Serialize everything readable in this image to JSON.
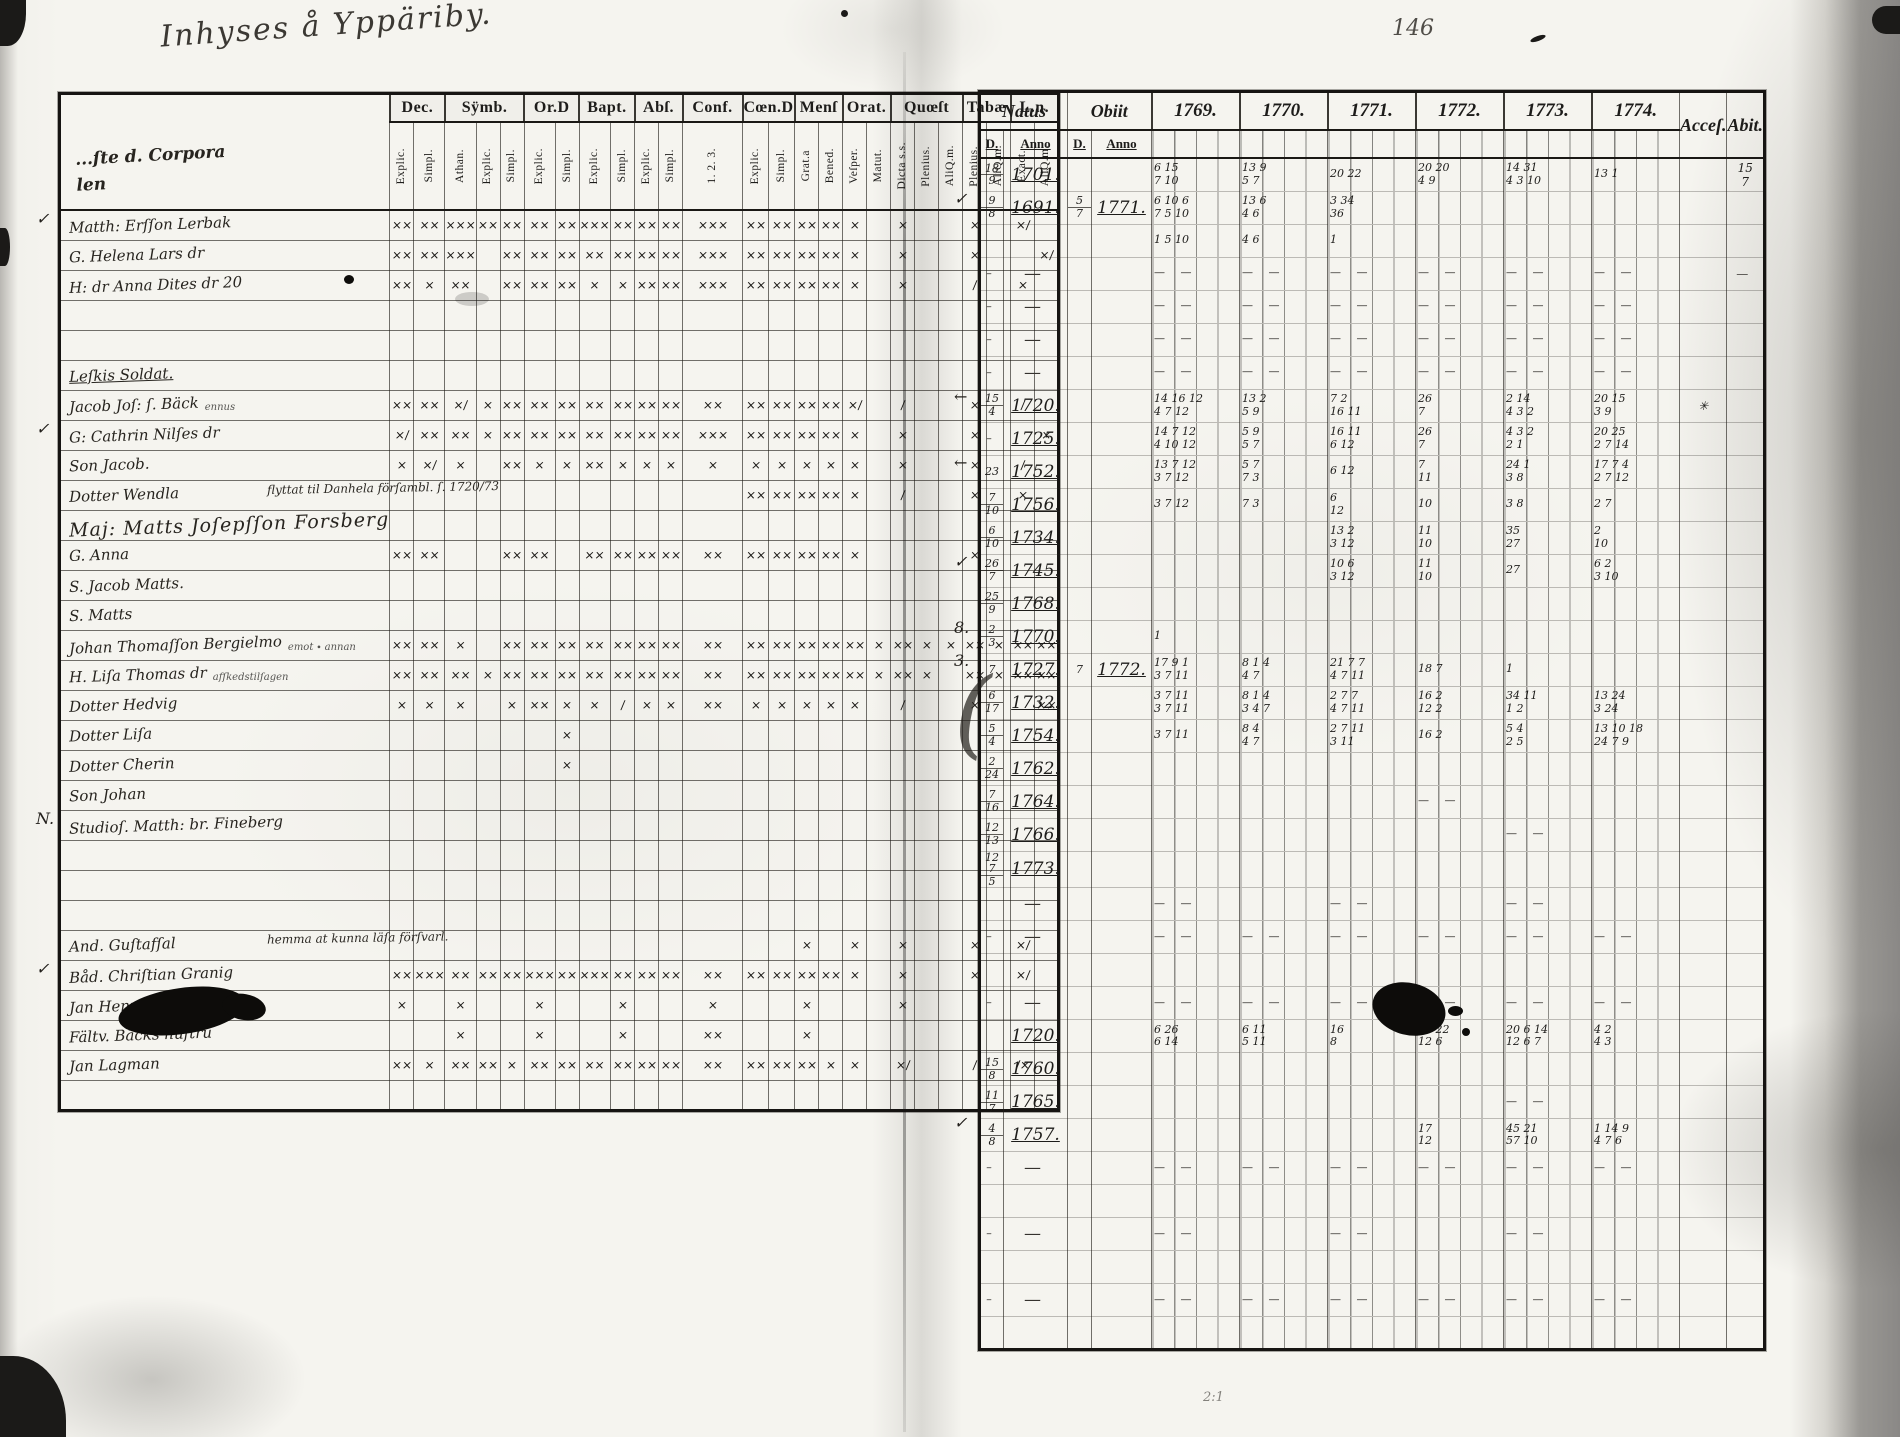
{
  "inscription": "Inhyses å Yppäriby.",
  "page_number": "146",
  "bottom_mark": "2:1",
  "left_table": {
    "name_header_lines": [
      "...ſte d. Corpora",
      "len"
    ],
    "groups": [
      {
        "label": "Dec.",
        "subs": [
          "Explic.",
          "Simpl."
        ]
      },
      {
        "label": "Sÿmb.",
        "subs": [
          "Athan.",
          "Explic.",
          "Simpl."
        ]
      },
      {
        "label": "Or.D",
        "subs": [
          "Explic.",
          "Simpl."
        ]
      },
      {
        "label": "Bapt.",
        "subs": [
          "Explic.",
          "Simpl."
        ]
      },
      {
        "label": "Abſ.",
        "subs": [
          "Explic.",
          "Simpl."
        ]
      },
      {
        "label": "Conf.",
        "subs": [
          "1. 2. 3."
        ]
      },
      {
        "label": "Cœn.D",
        "subs": [
          "Explic.",
          "Simpl."
        ]
      },
      {
        "label": "Menſ",
        "subs": [
          "Grat.a",
          "Bened."
        ]
      },
      {
        "label": "Orat.",
        "subs": [
          "Veſper.",
          "Matut."
        ]
      },
      {
        "label": "Quœſt",
        "subs": [
          "Dicta s.s.",
          "Plenius.",
          "AliQ.m."
        ]
      },
      {
        "label": "Tabæ",
        "subs": [
          "Plenius.",
          "AliQ.m."
        ]
      },
      {
        "label": "L.n.",
        "subs": [
          "Exact.",
          "AliQ.m."
        ]
      }
    ],
    "col_widths": [
      24,
      24,
      24,
      24,
      24,
      24,
      24,
      24,
      24,
      24,
      24,
      60,
      24,
      24,
      24,
      24,
      24,
      24,
      24,
      24,
      24,
      24,
      24,
      24,
      24
    ],
    "name_col_width": 185,
    "rows": [
      {
        "c": "✓",
        "n": "Matth: Erſſon Lerbak",
        "mk": "xx xx xxx xx xx xx xx xxx xx xx xx xxx xx xx xx xx x . x . . x . x/ ."
      },
      {
        "n": "G. Helena Lars dr",
        "mk": "xx xx xxx . xx xx xx xx xx xx xx xxx xx xx xx xx x . x . . x . . x/"
      },
      {
        "n": "H: dr Anna Dites dr 20",
        "mk": "xx x xx . xx xx xx x x xx xx xxx xx xx xx xx x . x . . / . x ."
      },
      {
        "n": "",
        "mk": ". . . . . . . . . . . . . . . . . . . . . . . . ."
      },
      {
        "n": "",
        "mk": ". . . . . . . . . . . . . . . . . . . . . . . . ."
      },
      {
        "n": "Leſkis Soldat.",
        "cls": "heading",
        "mk": ". . . . . . . . . . . . . . . . . . . . . . . . ."
      },
      {
        "n": "Jacob Joſ: ſ. Bäck",
        "pre": "ennus",
        "mk": "xx xx x/ x xx xx xx xx xx xx xx xx xx xx xx xx x/ . / . . x . / ."
      },
      {
        "c": "✓",
        "n": "G: Cathrin Nilſes dr",
        "mk": "x/ xx xx x xx xx xx xx xx xx xx xxx xx xx xx xx x . x . . x . . x"
      },
      {
        "n": "Son Jacob.",
        "mk": "x x/ x . xx x x xx x x x x x x x x x . x . . x . / ."
      },
      {
        "n": "Dotter Wendla",
        "span": {
          "s": 1,
          "e": 11,
          "t": "flyttat til Danhela förſambl. ſ. 1720/73"
        },
        "mk": ". . . . . . . . . . . . xx xx xx xx x . / . . x . x ."
      },
      {
        "n": "Maj: Matts Joſepſſon Forsberg",
        "cls": "big",
        "mk": ". . . . . . . . . . . . . . . . . . . . . . . . ."
      },
      {
        "n": "G. Anna",
        "mk": "xx xx . . xx xx . xx xx xx xx xx xx xx xx xx x . . . . x . . ."
      },
      {
        "n": "S. Jacob Matts.",
        "mk": ". . . . . . . . . . . . . . . . . . . . . . . . ."
      },
      {
        "n": "S. Matts",
        "mk": ". . . . . . . . . . . . . . . . . . . . . . . . ."
      },
      {
        "n": "Johan Thomaſſon Bergielmo",
        "pre": "emot ∙ annan",
        "mk": "xx xx x . xx xx xx xx xx xx xx xx xx xx xx xx xx x xx x x xx x xx xx"
      },
      {
        "n": "H. Liſa Thomas dr",
        "pre": "afſkedstilſagen",
        "mk": "xx xx xx x xx xx xx xx xx xx xx xx xx xx xx xx xx x xx x . xx x xx xx"
      },
      {
        "n": "Dotter Hedvig",
        "mk": "x x x . x xx x x / x x xx x x x x x . / . . x . . xx"
      },
      {
        "n": "Dotter Liſa",
        "mk": ". . . . . . x . . . . . . . . . . . . . . . . . ."
      },
      {
        "n": "Dotter Cherin",
        "mk": ". . . . . . x . . . . . . . . . . . . . . . . . ."
      },
      {
        "n": "Son Johan",
        "mk": ". . . . . . . . . . . . . . . . . . . . . . . . ."
      },
      {
        "c": "N.",
        "n": "Studioſ. Matth: br. Fineberg",
        "mk": ". . . . . . . . . . . . . . . . . . . . . . . . ."
      },
      {
        "n": "",
        "mk": ". . . . . . . . . . . . . . . . . . . . . . . . ."
      },
      {
        "n": "",
        "mk": ". . . . . . . . . . . . . . . . . . . . . . . . ."
      },
      {
        "n": "",
        "mk": ". . . . . . . . . . . . . . . . . . . . . . . . ."
      },
      {
        "n": "And. Guſtafſal",
        "span": {
          "s": 1,
          "e": 13,
          "t": "hemma at kunna läſa förſvarl."
        },
        "mk": ". . . . . . . . . . . . . . x . x . x . . x . x/ ."
      },
      {
        "c": "✓",
        "n": "Båd. Chriſtian Granig",
        "mk": "xx xxx xx xx xx xxx xx xxx xx xx xx xx xx xx xx xx x . x . . x . x/ ."
      },
      {
        "n": "Jan Henrig Söderberg",
        "mk": "x . x . . x . . x . . x . . x . . . x . . . . . ."
      },
      {
        "n": "Fältv. Bäcks huſtru",
        "mk": ". . x . . x . . x . . xx . . x . . . . . . . . . ."
      },
      {
        "n": "Jan Lagman",
        "mk": "xx x xx xx x xx xx xx xx xx xx xx xx xx xx x x . x/ . . / . /x ."
      },
      {
        "n": "",
        "mk": ". . . . . . . . . . . . . . . . . . . . . . . . ."
      }
    ]
  },
  "right_table": {
    "natus_label": "Natus",
    "obiit_label": "Obiit",
    "day_label": "D.",
    "anno_label": "Anno",
    "years": [
      "1769.",
      "1770.",
      "1771.",
      "1772.",
      "1773.",
      "1774."
    ],
    "acces_label": "Acceſ.",
    "abit_label": "Abit.",
    "rows": [
      [
        "",
        "18|9",
        "1701.",
        "",
        "",
        [
          "6 15|7 10",
          "13 9|5 7",
          "20 22",
          "20 20|4 9",
          "14 31|4 3 10",
          "13 1"
        ],
        "",
        "15|7"
      ],
      [
        "✓",
        "9|8",
        "1691.",
        "5|7",
        "1771.",
        [
          "6 10 6|7 5 10",
          "13 6|4 6",
          "3 34|36",
          "",
          "",
          ""
        ],
        "",
        ""
      ],
      [
        "",
        "",
        "",
        "",
        "",
        [
          "1 5 10",
          "4 6",
          "1",
          "",
          "",
          ""
        ],
        "",
        ""
      ],
      [
        "",
        "–",
        "—",
        "",
        "",
        [
          "— —",
          "— —",
          "— —",
          "— —",
          "— —",
          "— —"
        ],
        "",
        "—"
      ],
      [
        "",
        "–",
        "—",
        "",
        "",
        [
          "— —",
          "— —",
          "— —",
          "— —",
          "— —",
          "— —"
        ],
        "",
        ""
      ],
      [
        "",
        "–",
        "—",
        "",
        "",
        [
          "— —",
          "— —",
          "— —",
          "— —",
          "— —",
          "— —"
        ],
        "",
        ""
      ],
      [
        "",
        "–",
        "—",
        "",
        "",
        [
          "— —",
          "— —",
          "— —",
          "— —",
          "— —",
          "— —"
        ],
        "",
        ""
      ],
      [
        "←",
        "15|4",
        "1720.",
        "",
        "",
        [
          "14 16 12|4 7 12",
          "13 2|5 9",
          "7 2|16 11",
          "26|7",
          "2 14|4 3 2",
          "20 15|3 9"
        ],
        "✳",
        ""
      ],
      [
        "",
        "–",
        "1725.",
        "",
        "",
        [
          "14 7 12|4 10 12",
          "5 9|5 7",
          "16 11|6 12",
          "26|7",
          "4 3 2|2 1",
          "20 25|2 7 14"
        ],
        "",
        ""
      ],
      [
        "←",
        "23",
        "1752.",
        "",
        "",
        [
          "13 7 12|3 7 12",
          "5 7|7 3",
          "6 12",
          "7|11",
          "24 1|3 8",
          "17 7 4|2 7 12"
        ],
        "",
        ""
      ],
      [
        "",
        "7|10",
        "1756.",
        "",
        "",
        [
          "3 7 12",
          "7 3",
          "6|12",
          "10",
          "3 8",
          "2 7"
        ],
        "",
        ""
      ],
      [
        "",
        "6|10",
        "1734.",
        "",
        "",
        [
          "",
          "",
          "13 2|3 12",
          "11|10",
          "35|27",
          "2|10"
        ],
        "",
        ""
      ],
      [
        "✓",
        "26|7",
        "1745.",
        "",
        "",
        [
          "",
          "",
          "10 6|3 12",
          "11|10",
          "27",
          "6 2|3 10"
        ],
        "",
        ""
      ],
      [
        "",
        "25|9",
        "1768.",
        "",
        "",
        [
          "",
          "",
          "",
          "",
          "",
          ""
        ],
        "",
        ""
      ],
      [
        "8.",
        "2|3",
        "1770.",
        "",
        "",
        [
          "1",
          "",
          "",
          "",
          "",
          ""
        ],
        "",
        ""
      ],
      [
        "3.",
        "7",
        "1727.",
        "7",
        "1772.",
        [
          "17 9 1|3 7 11",
          "8 1 4|4 7",
          "21 7 7|4 7 11",
          "18 7",
          "1",
          ""
        ],
        "",
        ""
      ],
      [
        "(",
        "6|17",
        "1732.",
        "",
        "",
        [
          "3 7 11|3 7 11",
          "8 1 4|3 4 7",
          "2 7 7|4 7 11",
          "16 2|12 2",
          "34 11|1 2",
          "13 24|3 24"
        ],
        "",
        ""
      ],
      [
        "",
        "5|4",
        "1754.",
        "",
        "",
        [
          "3 7 11",
          "8 4|4 7",
          "2 7 11|3 11",
          "16 2",
          "5 4|2 5",
          "13 10 18|24 7 9"
        ],
        "",
        ""
      ],
      [
        "",
        "2|24",
        "1762.",
        "",
        "",
        [
          "",
          "",
          "",
          "",
          "",
          ""
        ],
        "",
        ""
      ],
      [
        "",
        "7|16",
        "1764.",
        "",
        "",
        [
          "",
          "",
          "",
          "— —",
          "",
          ""
        ],
        "",
        ""
      ],
      [
        "",
        "12|13",
        "1766.",
        "",
        "",
        [
          "",
          "",
          "",
          "",
          "— —",
          ""
        ],
        "",
        ""
      ],
      [
        "",
        "12 7|5",
        "1773.",
        "",
        "",
        [
          "",
          "",
          "",
          "",
          "",
          ""
        ],
        "",
        ""
      ],
      [
        "",
        "",
        "—",
        "",
        "",
        [
          "— —",
          "",
          "— —",
          "",
          "— —",
          ""
        ],
        "",
        ""
      ],
      [
        "",
        "–",
        "—",
        "",
        "",
        [
          "— —",
          "— —",
          "— —",
          "— —",
          "— —",
          "— —"
        ],
        "",
        ""
      ],
      [
        "",
        "",
        "",
        "",
        "",
        [
          "",
          "",
          "",
          "",
          "",
          ""
        ],
        "",
        ""
      ],
      [
        "",
        "–",
        "—",
        "",
        "",
        [
          "— —",
          "— —",
          "— —",
          "— —",
          "— —",
          "— —"
        ],
        "",
        ""
      ],
      [
        "",
        "",
        "1720.",
        "",
        "",
        [
          "6 26|6 14",
          "6 11|5 11",
          "16|8",
          "15 22|12 6",
          "20 6 14|12 6 7",
          "4 2|4 3"
        ],
        "",
        ""
      ],
      [
        "",
        "15|8",
        "1760.",
        "",
        "",
        [
          "",
          "",
          "",
          "",
          "",
          ""
        ],
        "",
        ""
      ],
      [
        "",
        "11|7",
        "1765.",
        "",
        "",
        [
          "",
          "",
          "",
          "",
          "— —",
          ""
        ],
        "",
        ""
      ],
      [
        "✓",
        "4|8",
        "1757.",
        "",
        "",
        [
          "",
          "",
          "",
          "17|12",
          "45 21|57 10",
          "1 14 9|4 7 6"
        ],
        "",
        ""
      ],
      [
        "",
        "–",
        "—",
        "",
        "",
        [
          "— —",
          "— —",
          "— —",
          "— —",
          "— —",
          "— —"
        ],
        "",
        ""
      ],
      [
        "",
        "",
        "",
        "",
        "",
        [
          "",
          "",
          "",
          "",
          "",
          ""
        ],
        "",
        ""
      ],
      [
        "",
        "–",
        "—",
        "",
        "",
        [
          "— —",
          "",
          "— —",
          "",
          "— —",
          ""
        ],
        "",
        ""
      ],
      [
        "",
        "",
        "",
        "",
        "",
        [
          "",
          "",
          "",
          "",
          "",
          ""
        ],
        "",
        ""
      ],
      [
        "",
        "–",
        "—",
        "",
        "",
        [
          "— —",
          "— —",
          "— —",
          "— —",
          "— —",
          "— —"
        ],
        "",
        ""
      ],
      [
        "",
        "",
        "",
        "",
        "",
        [
          "",
          "",
          "",
          "",
          "",
          ""
        ],
        "",
        ""
      ]
    ]
  },
  "mark_map": {
    ".": "",
    "x": "×",
    "xx": "××",
    "xxx": "×××",
    "/": "∕",
    "x/": "×∕",
    "/x": "∕×",
    "-": "—"
  }
}
